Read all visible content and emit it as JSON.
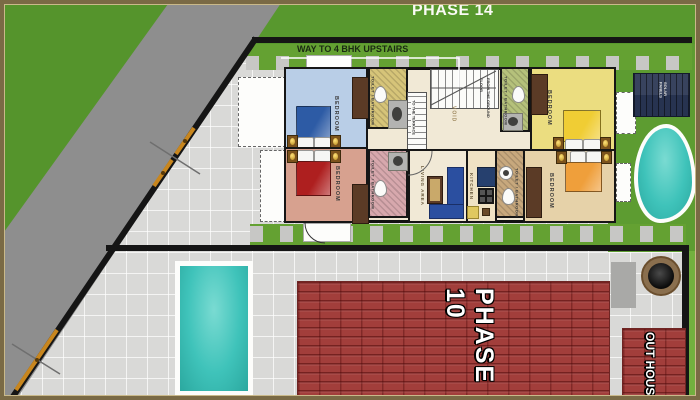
{
  "labels": {
    "phase14": "PHASE 14",
    "way": "WAY TO 4 BHK  UPSTAIRS",
    "bedroom": "BEDROOM",
    "toilet": "TOILET / BATHROOM",
    "living": "LIVING AREA",
    "kitchen": "KITCHEN",
    "void": "VOID",
    "terrace": "TO THE TERRACE",
    "ground_floor": "FROM THE GROUND FLOOR",
    "solar": "SOLAR PANELS",
    "phase10": "PHASE 10",
    "outhouse": "OUT HOUSE"
  },
  "colors": {
    "grass": "#58982e",
    "hedge": "#64a132",
    "road": "#8e8e8e",
    "paving": "#d9d9d7",
    "compound_wall": "#151515",
    "roof_red": "#a23e3b",
    "pool_water": "#3fc3ba",
    "gate_orange": "#c8861e",
    "bedroom_blue": "#b9cee7",
    "bedroom_yellow": "#ebdd80",
    "bedroom_salmon": "#d7a18f",
    "bedroom_tan": "#e6d2a9",
    "frame_tan": "#7a6a45"
  }
}
